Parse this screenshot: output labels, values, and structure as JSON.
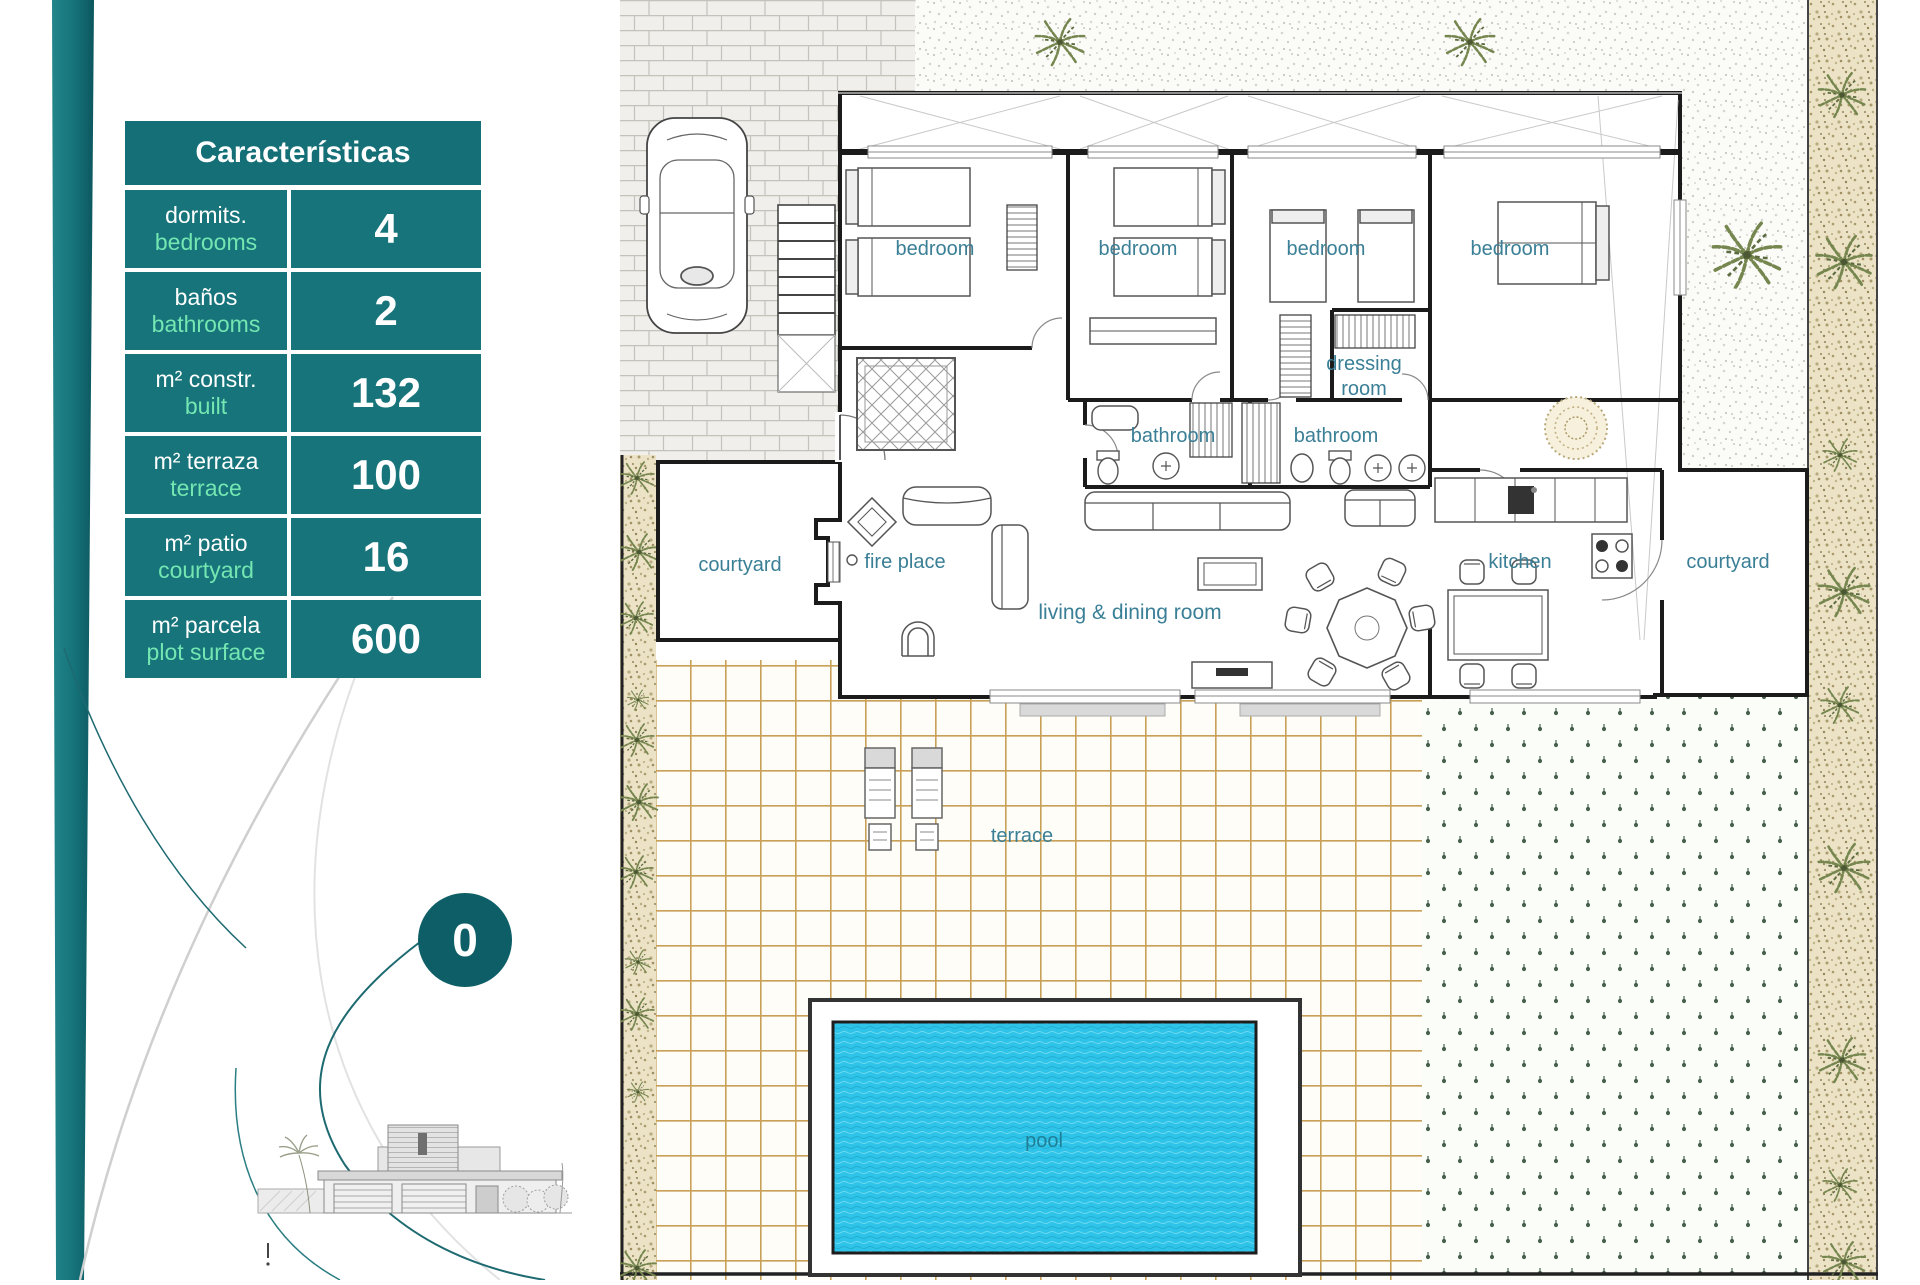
{
  "characteristics": {
    "title": "Características",
    "rows": [
      {
        "label_es": "dormits.",
        "label_en": "bedrooms",
        "value": "4"
      },
      {
        "label_es": "baños",
        "label_en": "bathrooms",
        "value": "2"
      },
      {
        "label_es": "m² constr.",
        "label_en": "built",
        "value": "132"
      },
      {
        "label_es": "m² terraza",
        "label_en": "terrace",
        "value": "100"
      },
      {
        "label_es": "m² patio",
        "label_en": "courtyard",
        "value": "16"
      },
      {
        "label_es": "m² parcela",
        "label_en": "plot surface",
        "value": "600"
      }
    ]
  },
  "badge": {
    "value": "0"
  },
  "plan_labels": {
    "bedroom1": "bedroom",
    "bedroom2": "bedroom",
    "bedroom3": "bedroom",
    "bedroom4": "bedroom",
    "dressing_line1": "dressing",
    "dressing_line2": "room",
    "bathroom1": "bathroom",
    "bathroom2": "bathroom",
    "courtyard_left": "courtyard",
    "courtyard_right": "courtyard",
    "fire_place": "fire place",
    "living": "living & dining room",
    "kitchen": "kitchen",
    "terrace": "terrace",
    "pool": "pool"
  },
  "colors": {
    "table_teal": "#17747a",
    "header_teal": "#156f76",
    "badge_teal": "#0d5e66",
    "label_green": "#74e6b2",
    "plan_label_blue": "#3a7f96",
    "pool_cyan": "#2ec3e8",
    "tile_tan": "#c9a057",
    "wall_black": "#1b1b1b"
  }
}
